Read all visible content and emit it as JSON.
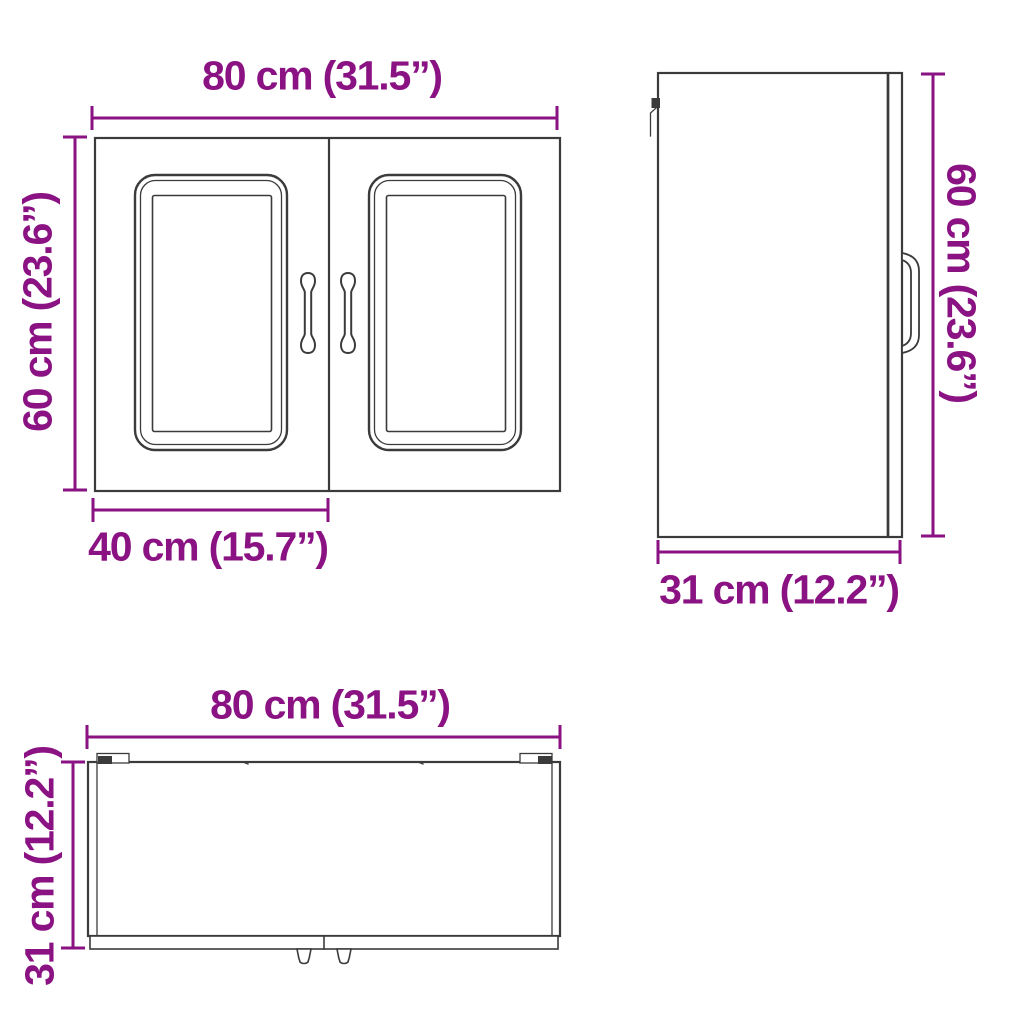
{
  "colors": {
    "accent": "#8A1283",
    "line": "#3B3B3B",
    "background": "#FFFFFF"
  },
  "views": {
    "front": {
      "width_label": "80 cm (31.5”)",
      "height_label": "60 cm (23.6”)",
      "door_width_label": "40 cm (15.7”)"
    },
    "side": {
      "height_label": "60 cm (23.6”)",
      "depth_label": "31 cm (12.2”)"
    },
    "top": {
      "width_label": "80 cm (31.5”)",
      "depth_label": "31 cm (12.2”)"
    }
  }
}
